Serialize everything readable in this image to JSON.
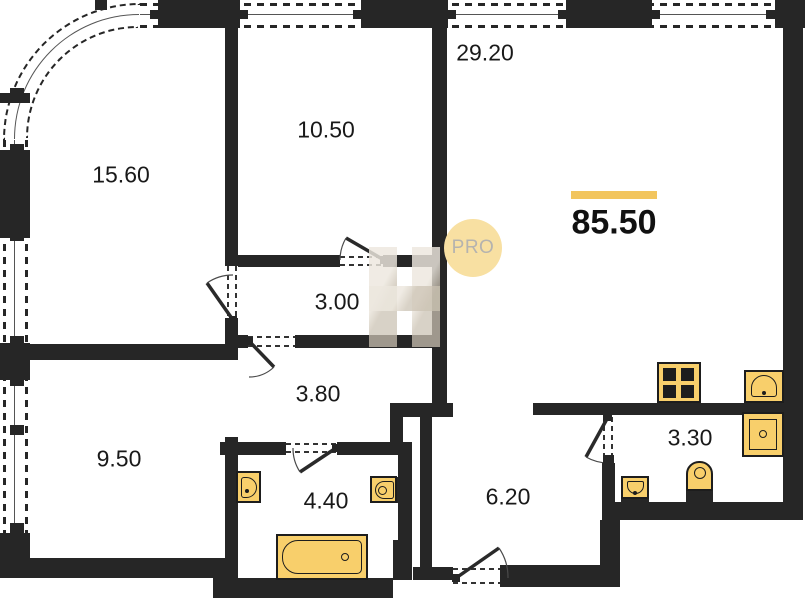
{
  "plan": {
    "badge": "PRO",
    "watermark_letter": "H",
    "total": {
      "area": "85.50"
    },
    "rooms": [
      {
        "area": "29.20"
      },
      {
        "area": "10.50"
      },
      {
        "area": "15.60"
      },
      {
        "area": "3.00"
      },
      {
        "area": "3.80"
      },
      {
        "area": "9.50"
      },
      {
        "area": "4.40"
      },
      {
        "area": "6.20"
      },
      {
        "area": "3.30"
      }
    ],
    "fixtures": [
      "stove-icon",
      "kitchen-sink-icon",
      "square-sink-icon",
      "toilet-icon",
      "small-sink-icon",
      "wall-sink-left-icon",
      "wall-sink-right-icon",
      "bathtub-icon"
    ]
  },
  "colors": {
    "wall": "#262626",
    "fixture-fill": "#F8CF6B",
    "fixture-stroke": "#1d1d1d",
    "accent": "#F2C55E",
    "badge-bg": "#F8E0A2",
    "badge-fg": "#B5B3AF",
    "ink": "#191919",
    "watermark": "rgba(221,211,194,0.72)"
  }
}
